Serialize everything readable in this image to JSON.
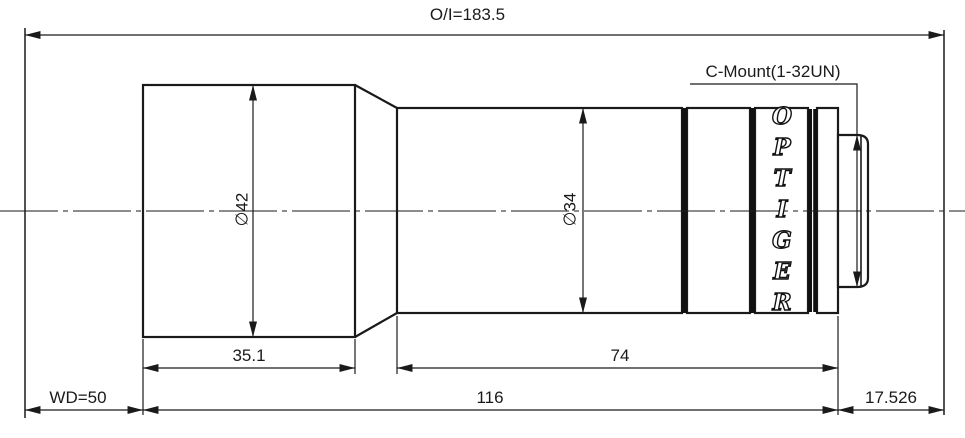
{
  "drawing": {
    "overall_dim": "O/I=183.5",
    "mount_label": "C-Mount(1-32UN)",
    "brand": "OPTIGER",
    "front_diameter": "∅42",
    "barrel_diameter": "∅34",
    "front_length": "35.1",
    "barrel_length": "74",
    "working_distance": "WD=50",
    "body_length": "116",
    "flange_distance": "17.526"
  },
  "colors": {
    "line": "#1a1a1a",
    "background": "#ffffff"
  }
}
